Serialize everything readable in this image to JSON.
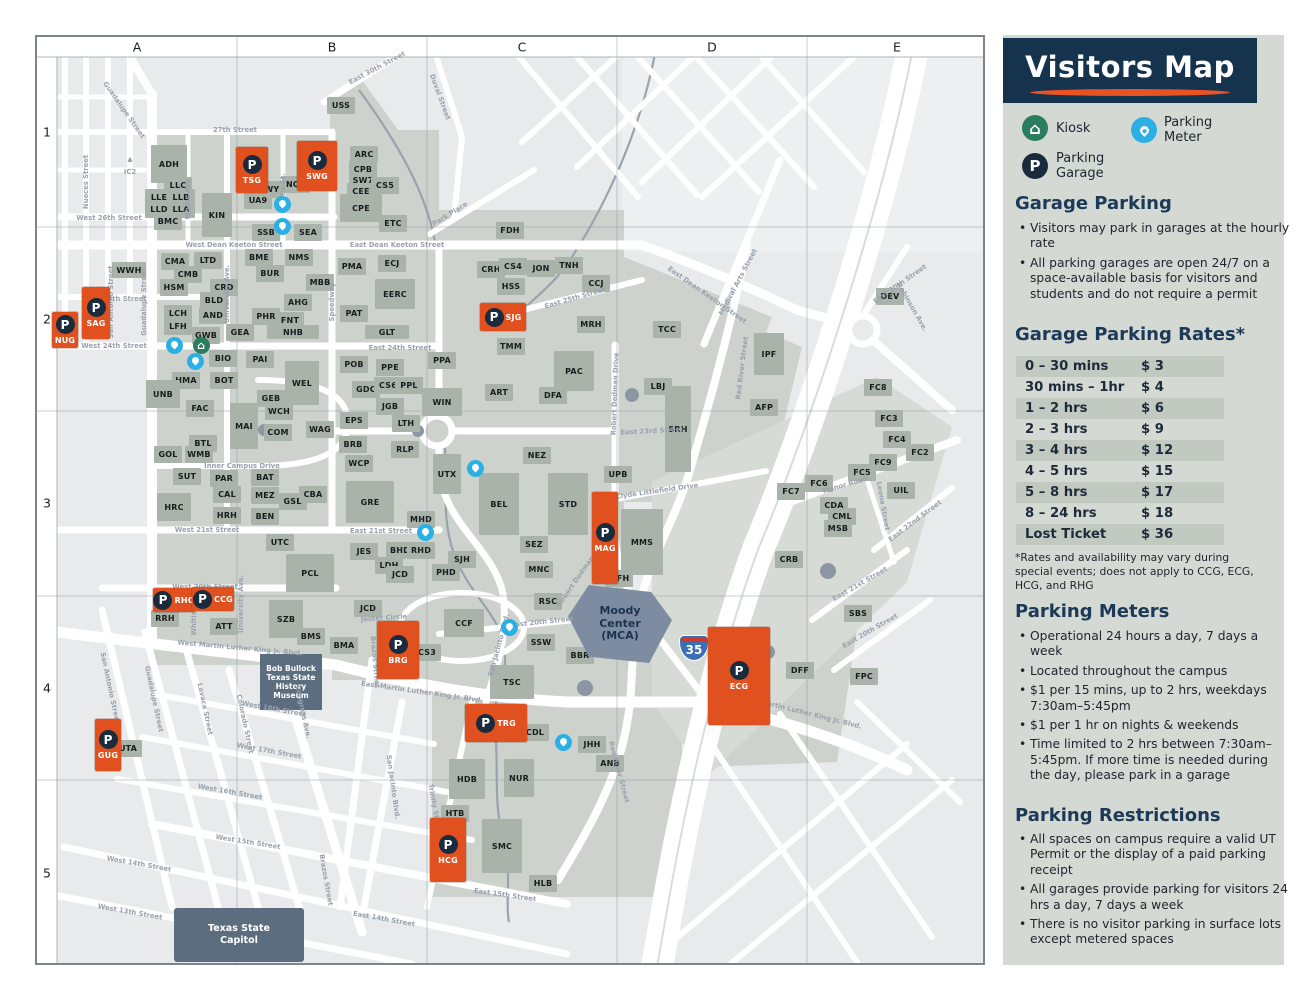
{
  "sidebar": {
    "title": "Visitors Map",
    "legend": {
      "kiosk": "Kiosk",
      "meter": "Parking\nMeter",
      "garage": "Parking\nGarage"
    },
    "garage_parking": {
      "heading": "Garage Parking",
      "bullets": [
        "Visitors may park in garages at the hourly rate",
        "All parking garages are open 24/7 on a space-available basis for visitors and students and do not require a permit"
      ]
    },
    "rates": {
      "heading": "Garage Parking Rates*",
      "rows": [
        [
          "0 – 30 mins",
          "$ 3"
        ],
        [
          "30 mins – 1hr",
          "$ 4"
        ],
        [
          "1 – 2 hrs",
          "$ 6"
        ],
        [
          "2 – 3 hrs",
          "$ 9"
        ],
        [
          "3 – 4 hrs",
          "$ 12"
        ],
        [
          "4 – 5 hrs",
          "$ 15"
        ],
        [
          "5 – 8 hrs",
          "$ 17"
        ],
        [
          "8 – 24 hrs",
          "$ 18"
        ],
        [
          "Lost Ticket",
          "$ 36"
        ]
      ],
      "footnote": "*Rates and availability may vary during special events; does not apply to CCG, ECG, HCG, and RHG"
    },
    "meters": {
      "heading": "Parking Meters",
      "bullets": [
        "Operational 24 hours a day, 7 days a week",
        "Located throughout the campus",
        "$1 per 15 mins, up to 2 hrs, weekdays 7:30am–5:45pm",
        "$1 per 1 hr on nights & weekends",
        "Time limited to 2 hrs between 7:30am–5:45pm. If more time is needed during the day, please park in a garage"
      ]
    },
    "restrictions": {
      "heading": "Parking Restrictions",
      "bullets": [
        "All spaces on campus require a valid UT Permit or the display of a paid parking receipt",
        "All garages provide parking for visitors 24 hrs a day, 7 days a week",
        "There is no visitor parking in surface lots except metered spaces"
      ]
    }
  },
  "map": {
    "grid": {
      "cols": [
        "A",
        "B",
        "C",
        "D",
        "E"
      ],
      "rows": [
        "1",
        "2",
        "3",
        "4",
        "5"
      ]
    },
    "interstate": "35",
    "landmarks": {
      "bob_bullock": "Bob Bullock\nTexas State\nHistory Museum",
      "capitol": "Texas State\nCapitol",
      "moody": "Moody\nCenter\n(MCA)"
    },
    "garages": [
      [
        "NUG",
        63,
        328,
        26,
        36
      ],
      [
        "SAG",
        94,
        311,
        28,
        52
      ],
      [
        "TSG",
        250,
        168,
        32,
        46
      ],
      [
        "SWG",
        315,
        164,
        40,
        50
      ],
      [
        "SJG",
        501,
        315,
        46,
        28
      ],
      [
        "MAG",
        603,
        536,
        26,
        92
      ],
      [
        "RHG",
        172,
        598,
        42,
        24
      ],
      [
        "CCG",
        211,
        597,
        42,
        24
      ],
      [
        "BRG",
        396,
        648,
        42,
        58
      ],
      [
        "TRG",
        494,
        721,
        62,
        38
      ],
      [
        "HCG",
        446,
        848,
        36,
        64
      ],
      [
        "GUG",
        106,
        743,
        26,
        52
      ],
      [
        "ECG",
        737,
        674,
        62,
        98
      ]
    ],
    "meters": [
      [
        280,
        202
      ],
      [
        280,
        224
      ],
      [
        172,
        343
      ],
      [
        193,
        359
      ],
      [
        473,
        466
      ],
      [
        423,
        530
      ],
      [
        507,
        625
      ],
      [
        561,
        740
      ]
    ],
    "kiosks": [
      [
        199,
        343
      ]
    ],
    "buildings": [
      [
        "ADH",
        167,
        162,
        36,
        38
      ],
      [
        "LLC",
        176,
        183
      ],
      [
        "LLE",
        157,
        195
      ],
      [
        "LLB",
        179,
        195
      ],
      [
        "LLD",
        157,
        207
      ],
      [
        "LLA",
        179,
        207
      ],
      [
        "BMC",
        166,
        219
      ],
      [
        "KIN",
        215,
        213,
        30,
        44
      ],
      [
        "USS",
        339,
        103
      ],
      [
        "BWY",
        267,
        187
      ],
      [
        "UA9",
        256,
        198
      ],
      [
        "NOA",
        294,
        182
      ],
      [
        "SSB",
        264,
        230
      ],
      [
        "SEA",
        306,
        230
      ],
      [
        "ARC",
        362,
        152
      ],
      [
        "CPB",
        361,
        167
      ],
      [
        "SW7",
        361,
        178
      ],
      [
        "CEE",
        359,
        189
      ],
      [
        "CS5",
        383,
        183
      ],
      [
        "CPE",
        359,
        206,
        42,
        28
      ],
      [
        "ETC",
        391,
        221
      ],
      [
        "FDH",
        508,
        228
      ],
      [
        "WWH",
        127,
        268,
        34,
        16
      ],
      [
        "CMA",
        173,
        259
      ],
      [
        "CMB",
        186,
        272
      ],
      [
        "HSM",
        172,
        285
      ],
      [
        "LTD",
        206,
        258
      ],
      [
        "CRD",
        222,
        285
      ],
      [
        "BLD",
        212,
        298
      ],
      [
        "LCH",
        176,
        311
      ],
      [
        "LFH",
        176,
        324
      ],
      [
        "AND",
        211,
        313
      ],
      [
        "GWB",
        204,
        333
      ],
      [
        "GEA",
        238,
        330
      ],
      [
        "BME",
        257,
        255
      ],
      [
        "BUR",
        268,
        271
      ],
      [
        "NMS",
        297,
        255
      ],
      [
        "MBB",
        318,
        280
      ],
      [
        "AHG",
        296,
        300
      ],
      [
        "PHR",
        264,
        314
      ],
      [
        "FNT",
        288,
        318
      ],
      [
        "NHB",
        291,
        330,
        52,
        14
      ],
      [
        "PMA",
        350,
        264
      ],
      [
        "ECJ",
        390,
        261
      ],
      [
        "EERC",
        393,
        292,
        40,
        30
      ],
      [
        "PAT",
        352,
        311
      ],
      [
        "GLT",
        385,
        330,
        44,
        14
      ],
      [
        "CRH",
        489,
        267
      ],
      [
        "CS4",
        511,
        264
      ],
      [
        "JON",
        539,
        266
      ],
      [
        "TNH",
        567,
        263
      ],
      [
        "HSS",
        509,
        284
      ],
      [
        "CCJ",
        594,
        281
      ],
      [
        "MRH",
        589,
        322
      ],
      [
        "TMM",
        509,
        344
      ],
      [
        "TCC",
        665,
        327
      ],
      [
        "BIO",
        221,
        356
      ],
      [
        "PAI",
        258,
        357
      ],
      [
        "BOT",
        222,
        378
      ],
      [
        "HMA",
        184,
        378
      ],
      [
        "UNB",
        161,
        392,
        34,
        28
      ],
      [
        "FAC",
        198,
        406
      ],
      [
        "WEL",
        300,
        381,
        34,
        44
      ],
      [
        "GEB",
        269,
        396
      ],
      [
        "WCH",
        277,
        409
      ],
      [
        "MAI",
        242,
        424,
        28,
        46
      ],
      [
        "COM",
        276,
        430
      ],
      [
        "WAG",
        318,
        427
      ],
      [
        "BTL",
        201,
        441
      ],
      [
        "WMB",
        197,
        452
      ],
      [
        "GOL",
        166,
        452
      ],
      [
        "SUT",
        185,
        474
      ],
      [
        "PAR",
        222,
        476
      ],
      [
        "BAT",
        263,
        475
      ],
      [
        "CAL",
        225,
        492
      ],
      [
        "MEZ",
        263,
        493
      ],
      [
        "GSB",
        291,
        499
      ],
      [
        "CBA",
        311,
        492
      ],
      [
        "HRC",
        172,
        505,
        34,
        28
      ],
      [
        "HRH",
        225,
        513
      ],
      [
        "BEN",
        263,
        514
      ],
      [
        "GRE",
        368,
        500,
        48,
        42
      ],
      [
        "POB",
        352,
        362
      ],
      [
        "PPE",
        388,
        365
      ],
      [
        "GDC",
        364,
        387
      ],
      [
        "CS6",
        386,
        383
      ],
      [
        "PPL",
        407,
        383
      ],
      [
        "JGB",
        388,
        404
      ],
      [
        "LTH",
        404,
        421
      ],
      [
        "EPS",
        352,
        418
      ],
      [
        "BRB",
        351,
        442
      ],
      [
        "RLP",
        403,
        447
      ],
      [
        "WCP",
        357,
        461
      ],
      [
        "PPA",
        440,
        358
      ],
      [
        "WIN",
        440,
        400,
        40,
        28
      ],
      [
        "UTX",
        445,
        472,
        28,
        40
      ],
      [
        "ART",
        497,
        390
      ],
      [
        "DFA",
        551,
        393
      ],
      [
        "PAC",
        572,
        369,
        40,
        40
      ],
      [
        "LBJ",
        656,
        384
      ],
      [
        "SRH",
        676,
        427,
        26,
        86
      ],
      [
        "IPF",
        767,
        352,
        30,
        42
      ],
      [
        "AFP",
        762,
        405
      ],
      [
        "UPB",
        616,
        472
      ],
      [
        "NEZ",
        535,
        453
      ],
      [
        "BEL",
        497,
        502,
        40,
        62
      ],
      [
        "STD",
        566,
        502,
        40,
        62
      ],
      [
        "SEZ",
        532,
        542
      ],
      [
        "MNC",
        537,
        567
      ],
      [
        "RSC",
        546,
        599
      ],
      [
        "MFH",
        617,
        576
      ],
      [
        "MMS",
        640,
        540,
        42,
        66
      ],
      [
        "SSW",
        539,
        640
      ],
      [
        "BBR",
        578,
        653
      ],
      [
        "TSC",
        510,
        680,
        44,
        34
      ],
      [
        "CDL",
        533,
        730
      ],
      [
        "JHH",
        590,
        742
      ],
      [
        "ANB",
        608,
        761
      ],
      [
        "HDB",
        465,
        777,
        36,
        40
      ],
      [
        "NUR",
        517,
        776,
        30,
        38
      ],
      [
        "HTB",
        453,
        811
      ],
      [
        "SMC",
        500,
        844,
        40,
        54
      ],
      [
        "HLB",
        541,
        881
      ],
      [
        "BMA",
        342,
        643
      ],
      [
        "CS3",
        425,
        650
      ],
      [
        "CCF",
        462,
        621,
        40,
        28
      ],
      [
        "UTC",
        278,
        540
      ],
      [
        "PCL",
        308,
        571,
        48,
        38
      ],
      [
        "SZB",
        284,
        617,
        34,
        38
      ],
      [
        "BMS",
        309,
        634
      ],
      [
        "RRH",
        163,
        616
      ],
      [
        "ATT",
        222,
        624
      ],
      [
        "JES",
        362,
        549
      ],
      [
        "BHD",
        398,
        548
      ],
      [
        "RHD",
        419,
        548
      ],
      [
        "LDH",
        387,
        563
      ],
      [
        "JCD",
        398,
        572
      ],
      [
        "JCD",
        366,
        606
      ],
      [
        "PHD",
        444,
        570
      ],
      [
        "SJH",
        460,
        557
      ],
      [
        "MHD",
        419,
        517
      ],
      [
        "SBS",
        856,
        611
      ],
      [
        "DFF",
        798,
        668
      ],
      [
        "FPC",
        862,
        674
      ],
      [
        "CRB",
        787,
        557
      ],
      [
        "DEV",
        888,
        294
      ],
      [
        "FC8",
        876,
        385
      ],
      [
        "FC3",
        887,
        416
      ],
      [
        "FC4",
        895,
        437
      ],
      [
        "FC2",
        918,
        450
      ],
      [
        "FC9",
        881,
        460
      ],
      [
        "FC5",
        860,
        470
      ],
      [
        "FC6",
        817,
        481
      ],
      [
        "FC7",
        789,
        489
      ],
      [
        "UIL",
        899,
        488
      ],
      [
        "CDA",
        832,
        503
      ],
      [
        "CML",
        840,
        514
      ],
      [
        "MSB",
        836,
        526
      ],
      [
        "UTA",
        126,
        746
      ]
    ],
    "street_labels": [
      [
        "27th Street",
        233,
        128,
        0
      ],
      [
        "West 26th Street",
        107,
        216,
        0
      ],
      [
        "West Dean Keeton Street",
        232,
        243,
        0
      ],
      [
        "East Dean Keeton Street",
        395,
        243,
        0
      ],
      [
        "East Dean Keeton Street",
        705,
        293,
        35
      ],
      [
        "West 25th Street",
        112,
        297,
        0
      ],
      [
        "West 24th Street",
        112,
        344,
        0
      ],
      [
        "East 24th Street",
        398,
        346,
        0
      ],
      [
        "East 25th Street",
        573,
        296,
        -16
      ],
      [
        "East 23rd Street",
        650,
        429,
        -3
      ],
      [
        "West 21st Street",
        205,
        528,
        0
      ],
      [
        "East 21st Street",
        379,
        529,
        0
      ],
      [
        "Inner Campus Drive",
        240,
        464,
        0
      ],
      [
        "Jester Circle",
        382,
        616,
        -4
      ],
      [
        "East 20th Street",
        540,
        620,
        -6
      ],
      [
        "West 20th Street",
        203,
        585,
        0
      ],
      [
        "West Martin Luther King Jr. Blvd.",
        238,
        646,
        5
      ],
      [
        "East Martin Luther King Jr. Blvd.",
        420,
        690,
        8
      ],
      [
        "East Martin Luther King Jr. Blvd.",
        800,
        710,
        14
      ],
      [
        "East 15th Street",
        503,
        893,
        8
      ],
      [
        "West 15th Street",
        246,
        840,
        9
      ],
      [
        "West 14th Street",
        137,
        862,
        10
      ],
      [
        "West 13th Street",
        128,
        910,
        10
      ],
      [
        "East 14th Street",
        382,
        917,
        10
      ],
      [
        "West 18th Street",
        272,
        707,
        10
      ],
      [
        "West 17th Street",
        267,
        749,
        10
      ],
      [
        "West 16th Street",
        228,
        790,
        10
      ],
      [
        "Nueces Street",
        84,
        180,
        -90
      ],
      [
        "Guadalupe Street",
        122,
        108,
        55
      ],
      [
        "Guadalupe Street",
        142,
        300,
        -90
      ],
      [
        "San Antonio Street",
        109,
        300,
        -90
      ],
      [
        "San Antonio Street",
        108,
        686,
        78
      ],
      [
        "Guadalupe Street",
        152,
        697,
        78
      ],
      [
        "Lavaca Street",
        203,
        707,
        78
      ],
      [
        "Colorado Street",
        243,
        722,
        78
      ],
      [
        "Congress Ave.",
        301,
        710,
        78
      ],
      [
        "Brazos Street",
        373,
        660,
        85
      ],
      [
        "Brazos Street",
        324,
        878,
        80
      ],
      [
        "University Ave.",
        225,
        292,
        -90
      ],
      [
        "University Ave.",
        239,
        602,
        -90
      ],
      [
        "Whitis Ave.",
        186,
        196,
        -90
      ],
      [
        "Whitis St.",
        281,
        190,
        -90
      ],
      [
        "Whitis Ave.",
        192,
        612,
        -90
      ],
      [
        "Speedway",
        330,
        300,
        -90
      ],
      [
        "San Jacinto Blvd.",
        497,
        643,
        -75
      ],
      [
        "San Jacinto Blvd.",
        391,
        785,
        82
      ],
      [
        "Trinity Street",
        433,
        807,
        80
      ],
      [
        "Red River Street",
        740,
        366,
        -83
      ],
      [
        "Red River Street",
        617,
        770,
        75
      ],
      [
        "Robert Dedman Drive",
        613,
        392,
        -88
      ],
      [
        "Robert Dedman Drive",
        580,
        570,
        -55
      ],
      [
        "Medical Arts Street",
        736,
        280,
        -62
      ],
      [
        "Duval Street",
        438,
        95,
        70
      ],
      [
        "Park Place",
        448,
        212,
        -32
      ],
      [
        "East 30th Street",
        375,
        66,
        -28
      ],
      [
        "East 30th Street",
        898,
        282,
        -35
      ],
      [
        "Robinson Ave.",
        910,
        305,
        60
      ],
      [
        "Clyde Littlefield Drive",
        655,
        489,
        -8
      ],
      [
        "Manor Road",
        843,
        483,
        -16
      ],
      [
        "East 22nd Street",
        913,
        519,
        -37
      ],
      [
        "Leona Street",
        881,
        504,
        80
      ],
      [
        "East 21st Street",
        858,
        582,
        -30
      ],
      [
        "East 20th Street",
        868,
        629,
        -30
      ],
      [
        "IC2",
        128,
        170,
        0
      ],
      [
        "▲",
        128,
        157,
        0
      ]
    ]
  },
  "colors": {
    "accent_orange": "#E8511F",
    "navy": "#16334E",
    "meter_blue": "#2BB0E6",
    "kiosk_green": "#2A7D5F",
    "garage_navy": "#1B2B3E",
    "sidebar_bg": "#D4D9D3",
    "campus_fill": "#CDD3CC",
    "building_fill": "#A9B3AA",
    "landmark_slate": "#5D6D80",
    "moody_slate": "#7E8CA1"
  }
}
